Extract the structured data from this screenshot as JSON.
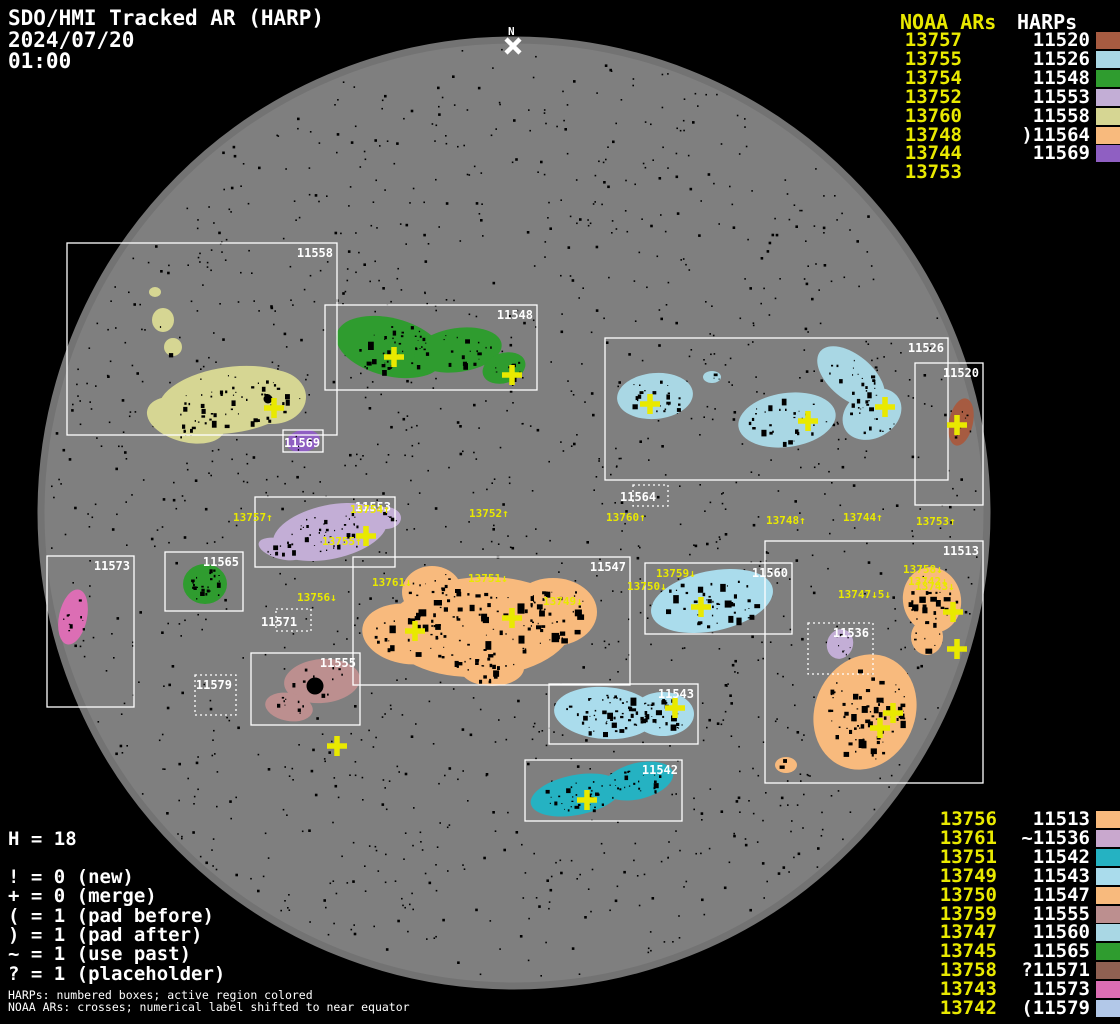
{
  "header": {
    "title": "SDO/HMI Tracked AR (HARP)",
    "date": "2024/07/20",
    "time": "01:00"
  },
  "north_marker_label": "N",
  "top_list": {
    "noaa_header": "NOAA ARs",
    "harp_header": "HARPs",
    "rows": [
      {
        "noaa": "13757",
        "harp": "11520",
        "swatch": "#a65b41"
      },
      {
        "noaa": "13755",
        "harp": "11526",
        "swatch": "#a9d7e4"
      },
      {
        "noaa": "13754",
        "harp": "11548",
        "swatch": "#2f9c2f"
      },
      {
        "noaa": "13752",
        "harp": "11553",
        "swatch": "#c3aed6"
      },
      {
        "noaa": "13760",
        "harp": "11558",
        "swatch": "#d6d693"
      },
      {
        "noaa": "13748",
        "harp": ")11564",
        "swatch": "#f8ba7d"
      },
      {
        "noaa": "13744",
        "harp": "11569",
        "swatch": "#8f5fc2"
      },
      {
        "noaa": "13753",
        "harp": "",
        "swatch": null
      }
    ]
  },
  "bottom_list": {
    "rows": [
      {
        "noaa": "13756",
        "harp": "11513",
        "swatch": "#f8ba7d"
      },
      {
        "noaa": "13761",
        "harp": "~11536",
        "swatch": "#c9a8ce"
      },
      {
        "noaa": "13751",
        "harp": "11542",
        "swatch": "#25b2c2"
      },
      {
        "noaa": "13749",
        "harp": "11543",
        "swatch": "#aadcec"
      },
      {
        "noaa": "13750",
        "harp": "11547",
        "swatch": "#f8ba7d"
      },
      {
        "noaa": "13759",
        "harp": "11555",
        "swatch": "#bc8f8f"
      },
      {
        "noaa": "13747",
        "harp": "11560",
        "swatch": "#a9d7e4"
      },
      {
        "noaa": "13745",
        "harp": "11565",
        "swatch": "#2f9c2f"
      },
      {
        "noaa": "13758",
        "harp": "?11571",
        "swatch": "#8f6052"
      },
      {
        "noaa": "13743",
        "harp": "11573",
        "swatch": "#dc6eb4"
      },
      {
        "noaa": "13742",
        "harp": "(11579",
        "swatch": "#b2c8e8"
      }
    ]
  },
  "legend": {
    "harp_count_line": "H = 18",
    "flag_lines": [
      "! = 0 (new)",
      "+ = 0 (merge)",
      "( = 1 (pad before)",
      ") = 1 (pad after)",
      "~ = 1 (use past)",
      "? = 1 (placeholder)"
    ]
  },
  "footnotes": [
    "HARPs: numbered boxes; active region colored",
    "NOAA ARs: crosses; numerical label shifted to near equator"
  ],
  "chart_data": {
    "type": "scatter",
    "title": "SDO/HMI Tracked AR (HARP)",
    "observation_date": "2024/07/20",
    "observation_time": "01:00",
    "harp_count": 18,
    "disk": {
      "cx": 514,
      "cy": 513,
      "r": 476,
      "color": "#7f7f7f"
    },
    "colors": {
      "label_yellow": "#e9e900",
      "box_white": "#ffffff",
      "background": "#000000"
    },
    "harp_boxes": [
      {
        "harp": "11558",
        "x": 67,
        "y": 243,
        "w": 270,
        "h": 192,
        "style": "solid"
      },
      {
        "harp": "11548",
        "x": 325,
        "y": 305,
        "w": 212,
        "h": 85,
        "style": "solid"
      },
      {
        "harp": "11526",
        "x": 605,
        "y": 338,
        "w": 343,
        "h": 142,
        "style": "solid"
      },
      {
        "harp": "11520",
        "x": 915,
        "y": 363,
        "w": 68,
        "h": 142,
        "style": "solid"
      },
      {
        "harp": "11569",
        "x": 283,
        "y": 430,
        "w": 40,
        "h": 22,
        "style": "solid",
        "lx": 284,
        "ly": 447
      },
      {
        "harp": "11564",
        "x": 633,
        "y": 485,
        "w": 35,
        "h": 21,
        "style": "dotted",
        "lx": 620,
        "ly": 501
      },
      {
        "harp": "11553",
        "x": 255,
        "y": 497,
        "w": 140,
        "h": 70,
        "style": "solid"
      },
      {
        "harp": "11513",
        "x": 765,
        "y": 541,
        "w": 218,
        "h": 242,
        "style": "solid"
      },
      {
        "harp": "11565",
        "x": 165,
        "y": 552,
        "w": 78,
        "h": 59,
        "style": "solid"
      },
      {
        "harp": "11573",
        "x": 47,
        "y": 556,
        "w": 87,
        "h": 151,
        "style": "solid"
      },
      {
        "harp": "11547",
        "x": 353,
        "y": 557,
        "w": 277,
        "h": 128,
        "style": "solid"
      },
      {
        "harp": "11560",
        "x": 645,
        "y": 563,
        "w": 147,
        "h": 71,
        "style": "solid"
      },
      {
        "harp": "11571",
        "x": 276,
        "y": 609,
        "w": 35,
        "h": 22,
        "style": "dotted",
        "lx": 261,
        "ly": 626
      },
      {
        "harp": "11536",
        "x": 808,
        "y": 623,
        "w": 65,
        "h": 51,
        "style": "dotted"
      },
      {
        "harp": "11555",
        "x": 251,
        "y": 653,
        "w": 109,
        "h": 72,
        "style": "solid"
      },
      {
        "harp": "11579",
        "x": 195,
        "y": 675,
        "w": 41,
        "h": 40,
        "style": "dotted"
      },
      {
        "harp": "11543",
        "x": 549,
        "y": 684,
        "w": 149,
        "h": 60,
        "style": "solid"
      },
      {
        "harp": "11542",
        "x": 525,
        "y": 760,
        "w": 157,
        "h": 61,
        "style": "solid"
      }
    ],
    "regions": [
      {
        "harp": "11558",
        "color": "#d6d693",
        "spots": 70,
        "smax": 5,
        "ellipses": [
          [
            230,
            400,
            72,
            33,
            -8
          ],
          [
            186,
            420,
            40,
            22,
            15
          ],
          [
            272,
            397,
            34,
            27,
            0
          ],
          [
            155,
            292,
            6,
            5,
            0
          ],
          [
            163,
            320,
            11,
            12,
            0
          ],
          [
            173,
            347,
            9,
            9,
            0
          ]
        ],
        "big_spots": [
          [
            268,
            399,
            4.5
          ]
        ]
      },
      {
        "harp": "11548",
        "color": "#2f9c2f",
        "spots": 70,
        "smax": 5,
        "ellipses": [
          [
            390,
            347,
            55,
            29,
            14
          ],
          [
            458,
            350,
            44,
            22,
            -8
          ],
          [
            504,
            368,
            22,
            15,
            -18
          ]
        ]
      },
      {
        "harp": "11526",
        "color": "#a9d7e4",
        "spots": 95,
        "smax": 5,
        "ellipses": [
          [
            655,
            396,
            38,
            23,
            -5
          ],
          [
            712,
            377,
            9,
            6,
            0
          ],
          [
            787,
            420,
            49,
            27,
            -8
          ],
          [
            851,
            377,
            40,
            22,
            40
          ],
          [
            872,
            414,
            31,
            24,
            -30
          ]
        ]
      },
      {
        "harp": "11520",
        "color": "#a65b41",
        "spots": 8,
        "smax": 3,
        "ellipses": [
          [
            961,
            422,
            12,
            24,
            12
          ]
        ]
      },
      {
        "harp": "11569",
        "color": "#8f5fc2",
        "spots": 8,
        "smax": 3,
        "ellipses": [
          [
            303,
            441,
            17,
            11,
            -10
          ]
        ]
      },
      {
        "harp": "11553",
        "color": "#c3aed6",
        "spots": 60,
        "smax": 5,
        "ellipses": [
          [
            330,
            532,
            58,
            27,
            -12
          ],
          [
            281,
            549,
            23,
            10,
            15
          ],
          [
            386,
            518,
            15,
            11,
            0
          ]
        ]
      },
      {
        "harp": "11565",
        "color": "#2f9c2f",
        "spots": 25,
        "smax": 4,
        "ellipses": [
          [
            205,
            584,
            22,
            20,
            0
          ]
        ]
      },
      {
        "harp": "11573",
        "color": "#dc6eb4",
        "spots": 10,
        "smax": 4,
        "ellipses": [
          [
            73,
            617,
            14,
            28,
            12
          ]
        ]
      },
      {
        "harp": "11547",
        "color": "#f8ba7d",
        "spots": 170,
        "smax": 8,
        "ellipses": [
          [
            480,
            627,
            93,
            50,
            -3
          ],
          [
            408,
            634,
            46,
            30,
            8
          ],
          [
            553,
            612,
            44,
            34,
            0
          ],
          [
            432,
            592,
            30,
            26,
            0
          ],
          [
            492,
            668,
            32,
            18,
            0
          ]
        ]
      },
      {
        "harp": "11560",
        "color": "#aadcec",
        "spots": 45,
        "smax": 6,
        "ellipses": [
          [
            712,
            601,
            62,
            30,
            -12
          ]
        ]
      },
      {
        "harp": "11536",
        "color": "#c3aed6",
        "spots": 8,
        "smax": 3,
        "ellipses": [
          [
            840,
            644,
            13,
            15,
            18
          ]
        ]
      },
      {
        "harp": "11513",
        "color": "#f8ba7d",
        "spots": 120,
        "smax": 7,
        "ellipses": [
          [
            932,
            600,
            29,
            33,
            -12
          ],
          [
            927,
            637,
            16,
            18,
            0
          ],
          [
            865,
            712,
            50,
            59,
            24
          ],
          [
            786,
            765,
            11,
            8,
            0
          ]
        ]
      },
      {
        "harp": "11555",
        "color": "#bc8f8f",
        "spots": 22,
        "smax": 4,
        "ellipses": [
          [
            322,
            681,
            38,
            22,
            -5
          ],
          [
            289,
            707,
            24,
            14,
            10
          ]
        ],
        "big_spots": [
          [
            315,
            686,
            8.5
          ]
        ]
      },
      {
        "harp": "11543",
        "color": "#aadcec",
        "spots": 85,
        "smax": 6,
        "ellipses": [
          [
            605,
            713,
            51,
            26,
            4
          ],
          [
            663,
            714,
            31,
            22,
            0
          ]
        ]
      },
      {
        "harp": "11542",
        "color": "#25b2c2",
        "spots": 60,
        "smax": 5,
        "ellipses": [
          [
            576,
            795,
            46,
            20,
            -11
          ],
          [
            638,
            781,
            36,
            18,
            -14
          ]
        ]
      }
    ],
    "noaa_crosses": [
      [
        274,
        408
      ],
      [
        394,
        357
      ],
      [
        512,
        375
      ],
      [
        650,
        404
      ],
      [
        808,
        421
      ],
      [
        885,
        407
      ],
      [
        957,
        425
      ],
      [
        366,
        536
      ],
      [
        415,
        631
      ],
      [
        512,
        618
      ],
      [
        701,
        607
      ],
      [
        675,
        708
      ],
      [
        587,
        800
      ],
      [
        337,
        746
      ],
      [
        893,
        713
      ],
      [
        880,
        728
      ],
      [
        953,
        612
      ],
      [
        957,
        649
      ]
    ],
    "noaa_labels": [
      {
        "text": "13757↑",
        "x": 233,
        "y": 512
      },
      {
        "text": "13754↑",
        "x": 350,
        "y": 504
      },
      {
        "text": "13755↑",
        "x": 322,
        "y": 536
      },
      {
        "text": "13752↑",
        "x": 469,
        "y": 508
      },
      {
        "text": "13760↑",
        "x": 606,
        "y": 512
      },
      {
        "text": "13748↑",
        "x": 766,
        "y": 515
      },
      {
        "text": "13744↑",
        "x": 843,
        "y": 512
      },
      {
        "text": "13753↑",
        "x": 916,
        "y": 516
      },
      {
        "text": "13761↓",
        "x": 372,
        "y": 577
      },
      {
        "text": "13756↓",
        "x": 297,
        "y": 592
      },
      {
        "text": "13751↓",
        "x": 468,
        "y": 573
      },
      {
        "text": "13749↓",
        "x": 543,
        "y": 596
      },
      {
        "text": "13750↓",
        "x": 627,
        "y": 581
      },
      {
        "text": "13759↓",
        "x": 656,
        "y": 568
      },
      {
        "text": "13747↓5↓",
        "x": 838,
        "y": 589
      },
      {
        "text": "13758↓",
        "x": 903,
        "y": 564
      },
      {
        "text": "13742↓",
        "x": 908,
        "y": 576
      },
      {
        "text": "13743↓",
        "x": 915,
        "y": 581
      }
    ]
  }
}
